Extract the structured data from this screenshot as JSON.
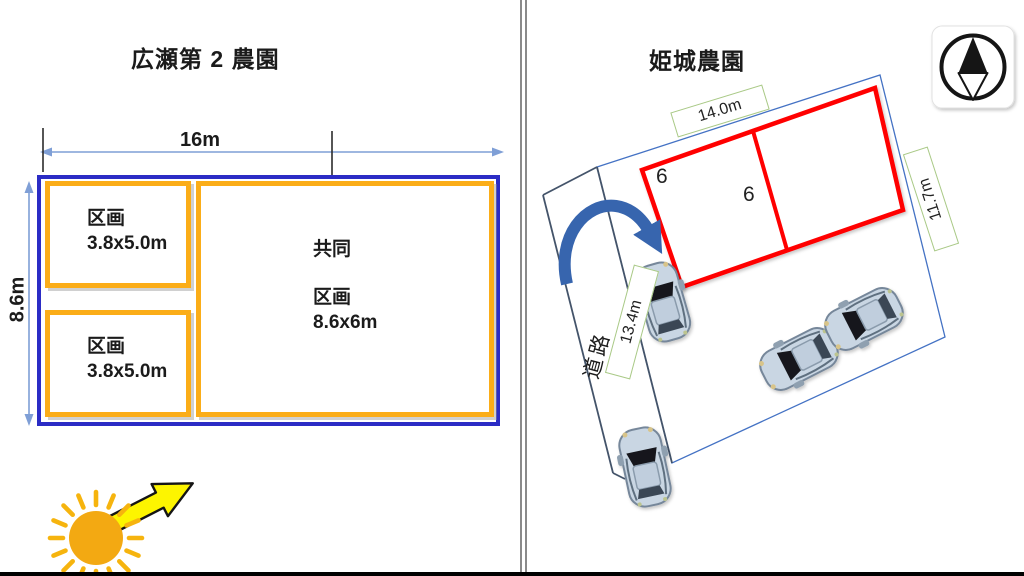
{
  "left": {
    "title": "広瀬第 2 農園",
    "width_dim": "16m",
    "height_dim": "8.6m",
    "plot1": {
      "label": "区画",
      "size": "3.8x5.0m"
    },
    "plot2": {
      "label": "区画",
      "size": "3.8x5.0m"
    },
    "shared": {
      "prefix": "共同",
      "label": "区画",
      "size": "8.6x6m"
    }
  },
  "right": {
    "title": "姫城農園",
    "top_dim": "14.0m",
    "side_dim": "11.7m",
    "road_dim": "13.4m",
    "road_label": "道路",
    "plot_counts": [
      "6",
      "6"
    ]
  },
  "icons": {
    "sun": "sun-icon",
    "sunlight_arrow": "sunlight-direction-arrow-icon",
    "north_compass": "north-compass-icon",
    "turn_arrow": "entrance-turn-arrow-icon",
    "car": "car-top-view-icon"
  },
  "colors": {
    "left_outer_border": "#2B2CC5",
    "left_plot_border": "#FBAD18",
    "dimension_line": "#7F9FD6",
    "sun": "#F3A912",
    "sun_arrow_fill": "#FDF500",
    "right_plot_border": "#FF0000",
    "label_box_border": "#A9C986",
    "site_boundary": "#4472C4",
    "road_line": "#44546A",
    "turn_arrow": "#3765AE"
  }
}
